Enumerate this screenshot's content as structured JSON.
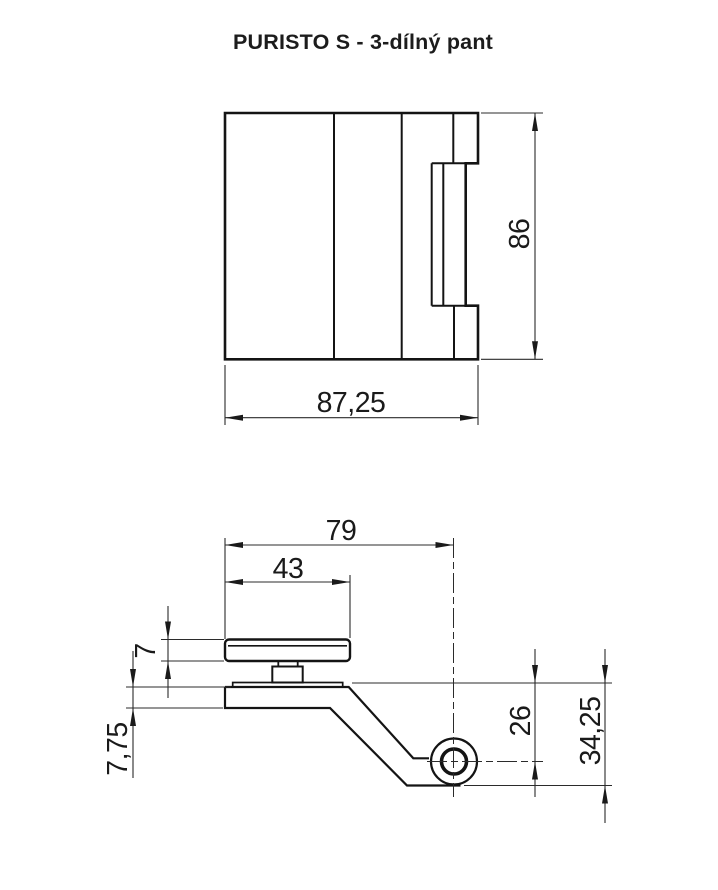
{
  "title": "PURISTO S - 3-dílný pant",
  "front_view": {
    "dim_height": "86",
    "dim_width": "87,25"
  },
  "side_view": {
    "dim_depth": "79",
    "dim_plate": "43",
    "dim_clamp_thickness": "7",
    "dim_base_thickness": "7,75",
    "dim_pivot_offset": "26",
    "dim_total_height": "34,25"
  },
  "colors": {
    "line": "#141414",
    "background": "#ffffff"
  }
}
